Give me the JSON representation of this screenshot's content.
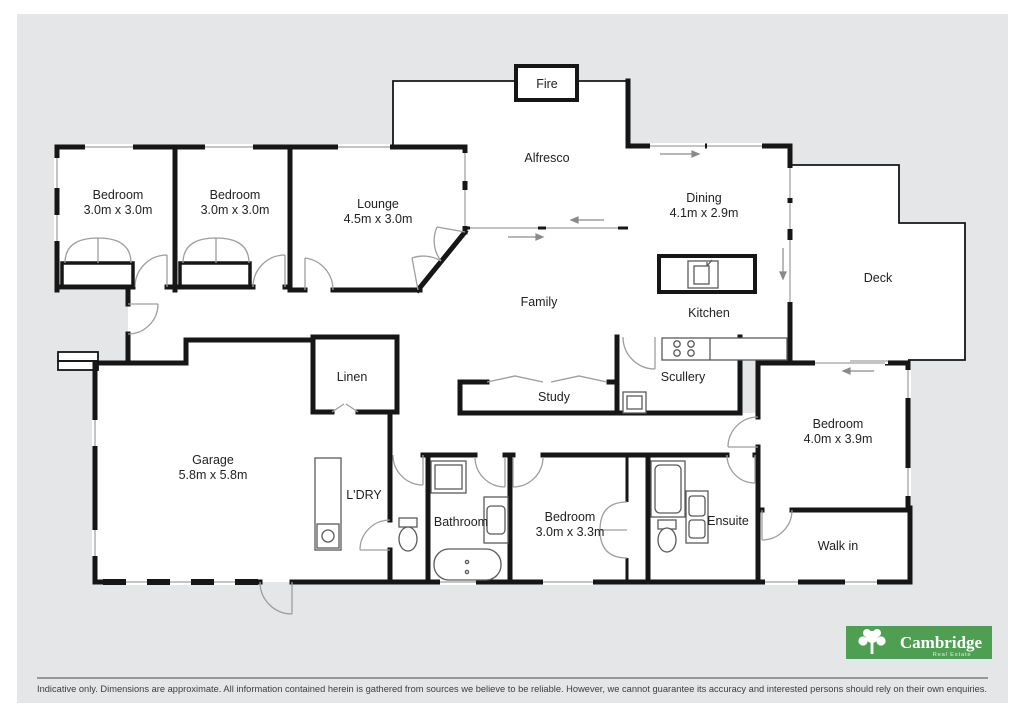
{
  "colors": {
    "canvas_grey": "#e5e6e8",
    "wall_black": "#161616",
    "window_grey": "#c4c4c4",
    "door_grey": "#9e9e9e",
    "logo_green": "#4f9f52"
  },
  "rooms": {
    "bedroom_front_1": {
      "label": "Bedroom",
      "dims": "3.0m x 3.0m"
    },
    "bedroom_front_2": {
      "label": "Bedroom",
      "dims": "3.0m x 3.0m"
    },
    "lounge": {
      "label": "Lounge",
      "dims": "4.5m x 3.0m"
    },
    "alfresco": {
      "label": "Alfresco"
    },
    "fire": {
      "label": "Fire"
    },
    "dining": {
      "label": "Dining",
      "dims": "4.1m x 2.9m"
    },
    "deck": {
      "label": "Deck"
    },
    "family": {
      "label": "Family"
    },
    "kitchen": {
      "label": "Kitchen"
    },
    "scullery": {
      "label": "Scullery"
    },
    "study": {
      "label": "Study"
    },
    "linen": {
      "label": "Linen"
    },
    "garage": {
      "label": "Garage",
      "dims": "5.8m x 5.8m"
    },
    "laundry": {
      "label": "L'DRY"
    },
    "bathroom": {
      "label": "Bathroom"
    },
    "bedroom_mid": {
      "label": "Bedroom",
      "dims": "3.0m x 3.3m"
    },
    "ensuite": {
      "label": "Ensuite"
    },
    "bedroom_master": {
      "label": "Bedroom",
      "dims": "4.0m x 3.9m"
    },
    "walk_in": {
      "label": "Walk in"
    }
  },
  "logo": {
    "name": "Cambridge",
    "tagline": "Real Estate"
  },
  "disclaimer": "Indicative only. Dimensions are approximate. All information contained herein is gathered from sources we believe to be reliable. However, we cannot guarantee its accuracy and interested persons should rely on their own enquiries."
}
